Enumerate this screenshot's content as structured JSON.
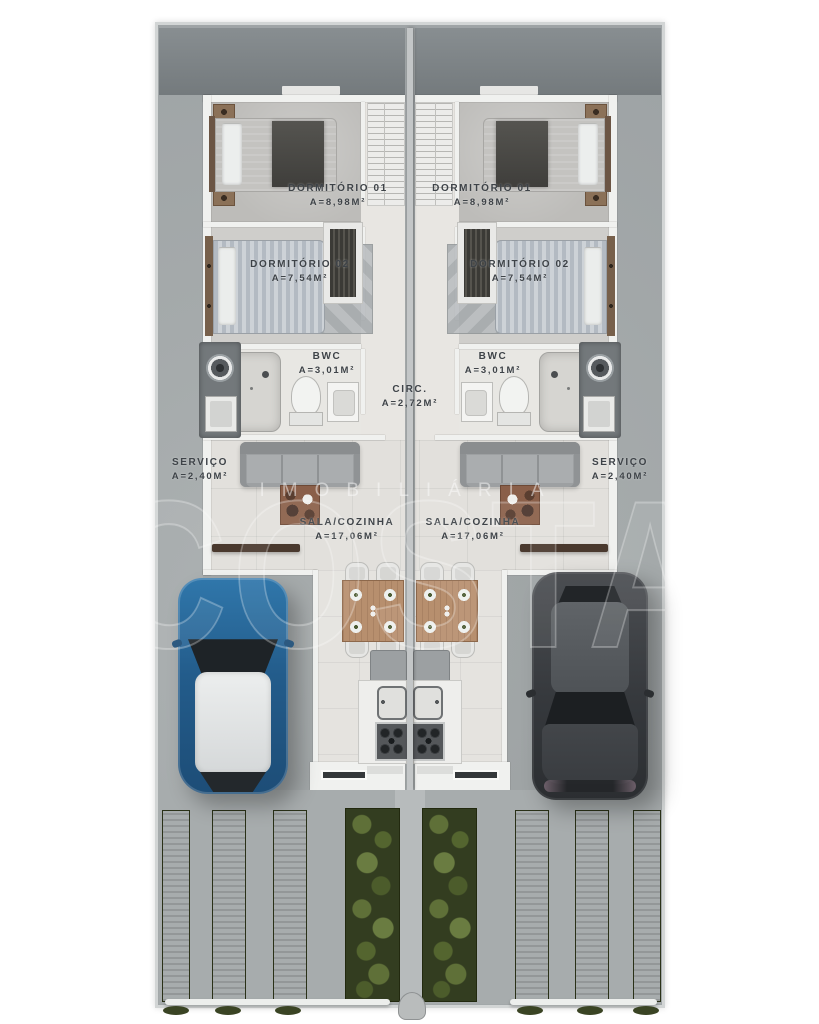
{
  "watermark": {
    "top": "IMOBILIÁRIA",
    "main": "COSTA"
  },
  "rooms": {
    "dormitorio1": {
      "name": "DORMITÓRIO 01",
      "area": "A=8,98M²"
    },
    "dormitorio2": {
      "name": "DORMITÓRIO 02",
      "area": "A=7,54M²"
    },
    "bwc": {
      "name": "BWC",
      "area": "A=3,01M²"
    },
    "circulacao": {
      "name": "CIRC.",
      "area": "A=2,72M²"
    },
    "servico": {
      "name": "SERVIÇO",
      "area": "A=2,40M²"
    },
    "sala_cozinha": {
      "name": "SALA/COZINHA",
      "area": "A=17,06M²"
    }
  },
  "colors": {
    "lot_concrete": "#a5aaab",
    "backyard": "#7c8285",
    "wall": "#f0f1ef",
    "house_floor": "#e2e0dc",
    "label_text": "#3e4348",
    "grass_strip": "#46502d",
    "hedge": "#333d20",
    "car_left_blue": "#2a6b9d",
    "car_right_dark": "#3a3d41"
  }
}
